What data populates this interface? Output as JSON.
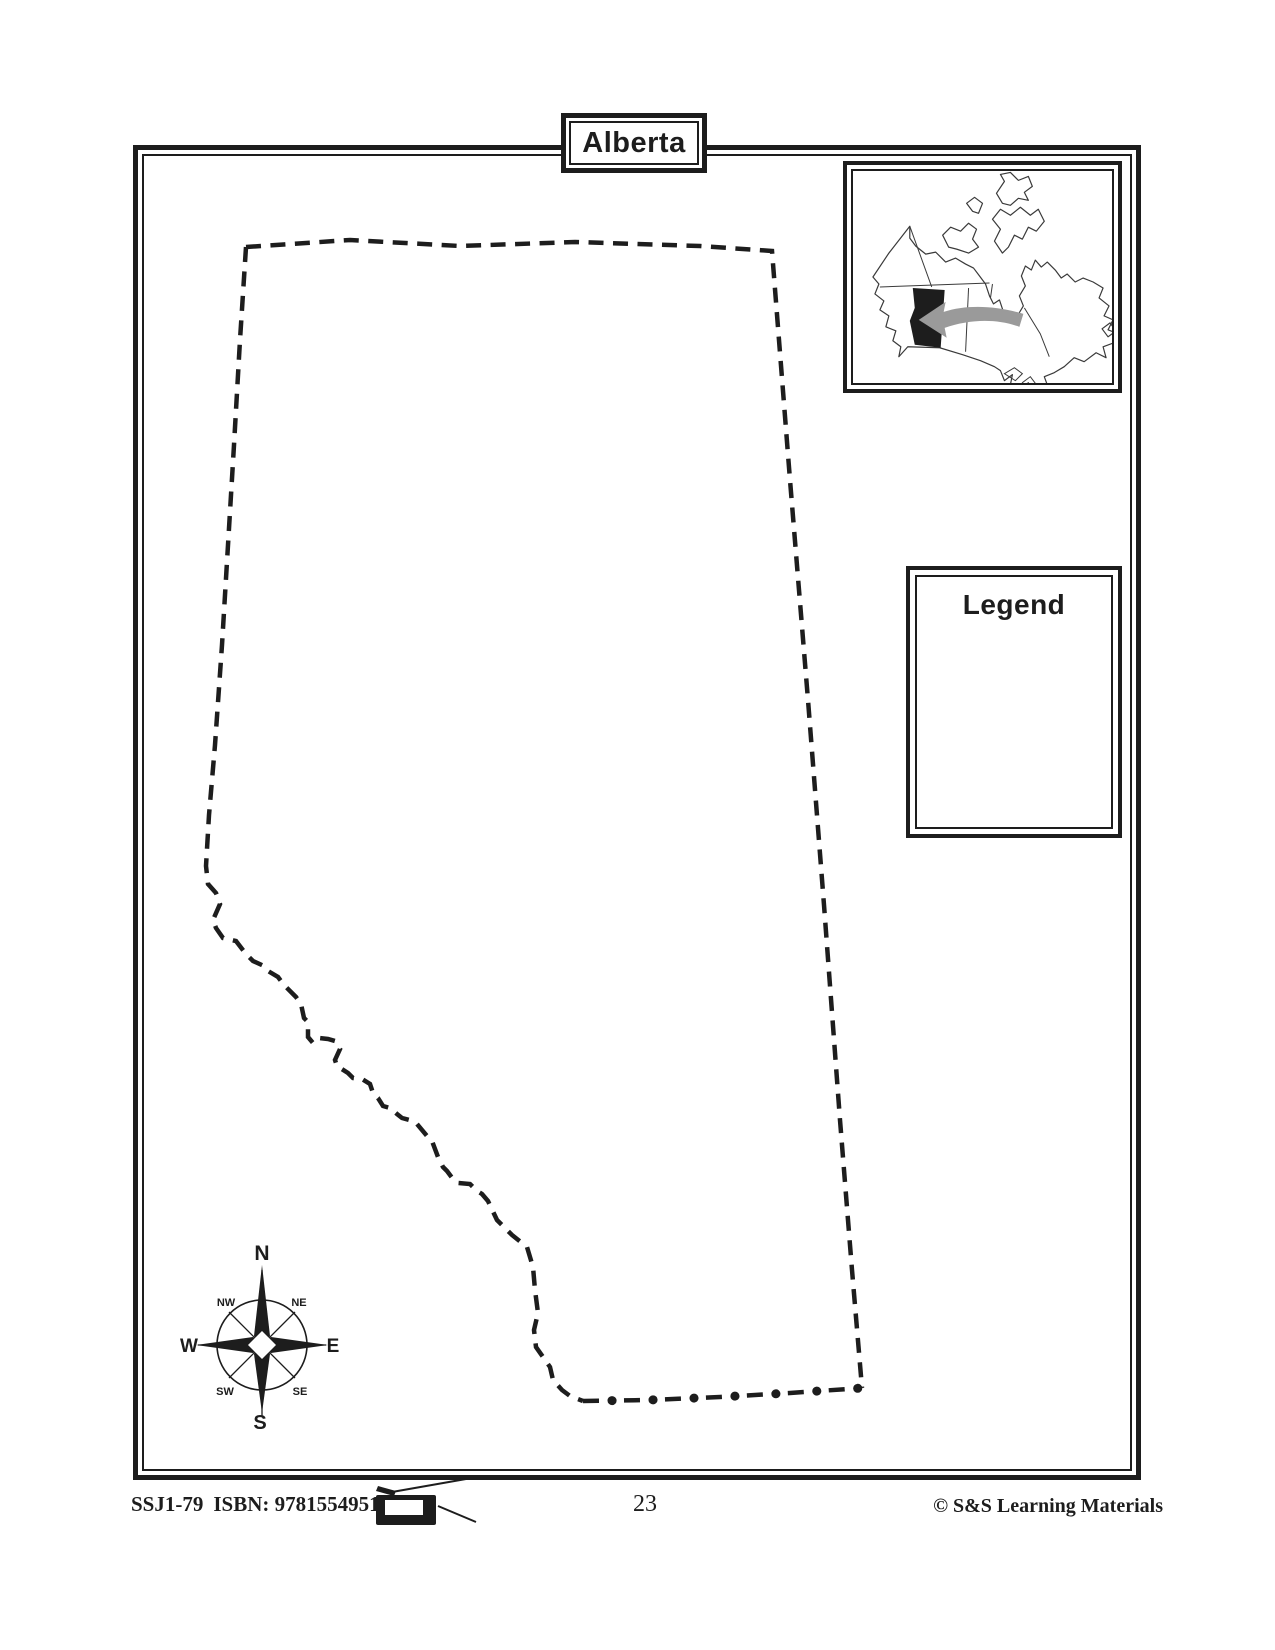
{
  "page": {
    "title": "Alberta",
    "page_number": "23",
    "background_color": "#ffffff",
    "ink_color": "#1d1d1d"
  },
  "map": {
    "region_name": "Alberta",
    "outline_style": "dashed",
    "south_border_style": "dash-dot"
  },
  "inset": {
    "description": "canada-locator-map",
    "highlighted_region": "Alberta",
    "arrow_color": "#9a9a9a"
  },
  "legend": {
    "title": "Legend"
  },
  "compass": {
    "n": "N",
    "ne": "NE",
    "e": "E",
    "se": "SE",
    "s": "S",
    "sw": "SW",
    "w": "W",
    "nw": "NW"
  },
  "footer": {
    "product_code": "SSJ1-79",
    "isbn": "ISBN: 9781554951031",
    "copyright": "© S&S Learning Materials"
  }
}
